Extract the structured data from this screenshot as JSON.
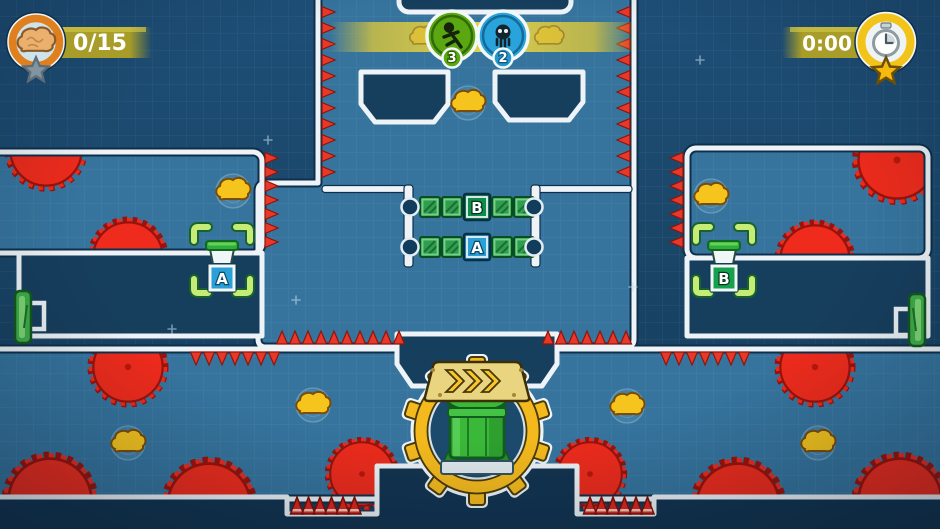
{
  "app": {
    "name": "co-op puzzle platformer level",
    "view": "level-playfield"
  },
  "hud": {
    "brains_counter": {
      "value": "0/15",
      "icon": "brain-icon",
      "medal_icon": "star-icon"
    },
    "timer": {
      "value": "0:00",
      "icon": "stopwatch-icon",
      "medal_icon": "star-icon"
    },
    "spawn_counters": [
      {
        "icon": "runner-icon",
        "color": "#5aa712",
        "count": "3"
      },
      {
        "icon": "skull-icon",
        "color": "#28a3dc",
        "count": "2"
      }
    ]
  },
  "labels": {
    "a": "A",
    "b": "B"
  },
  "level": {
    "bridges": [
      {
        "label": "B",
        "label_color": "#0e8c4a",
        "row": "top"
      },
      {
        "label": "A",
        "label_color": "#2b9fd8",
        "row": "bottom"
      }
    ],
    "targets": [
      {
        "label": "A",
        "side": "left",
        "sign_color": "#2b9fd8"
      },
      {
        "label": "B",
        "side": "right",
        "sign_color": "#16a14d"
      }
    ],
    "entities": {
      "brain_pickups": 7,
      "saw_blades": 12,
      "exit_doors": 2,
      "crate_bridges": 2,
      "spawner_pipes": 1,
      "goal_brackets": 2,
      "spike_pits": 2
    },
    "saws": [
      {
        "x": 46,
        "y": 150,
        "r": 37,
        "clip": "room-left"
      },
      {
        "x": 128,
        "y": 257,
        "r": 36,
        "clip": "room-left"
      },
      {
        "x": 897,
        "y": 160,
        "r": 40,
        "clip": "room-right"
      },
      {
        "x": 815,
        "y": 260,
        "r": 36,
        "clip": "room-right"
      },
      {
        "x": 50,
        "y": 500,
        "r": 43,
        "clip": "band"
      },
      {
        "x": 209,
        "y": 505,
        "r": 43,
        "clip": "band"
      },
      {
        "x": 128,
        "y": 367,
        "r": 36,
        "clip": "band"
      },
      {
        "x": 815,
        "y": 367,
        "r": 36,
        "clip": "band"
      },
      {
        "x": 362,
        "y": 474,
        "r": 33,
        "clip": "band"
      },
      {
        "x": 590,
        "y": 474,
        "r": 33,
        "clip": "band"
      },
      {
        "x": 738,
        "y": 505,
        "r": 43,
        "clip": "band"
      },
      {
        "x": 900,
        "y": 500,
        "r": 43,
        "clip": "band"
      }
    ],
    "brains": [
      {
        "x": 468,
        "y": 103
      },
      {
        "x": 233,
        "y": 191
      },
      {
        "x": 711,
        "y": 196
      },
      {
        "x": 128,
        "y": 443
      },
      {
        "x": 313,
        "y": 405
      },
      {
        "x": 627,
        "y": 406
      },
      {
        "x": 818,
        "y": 443
      }
    ],
    "spike_rows": [
      {
        "x": 322,
        "y": 12,
        "count": 11,
        "gap": 16,
        "dir": "right"
      },
      {
        "x": 630,
        "y": 12,
        "count": 11,
        "gap": 16,
        "dir": "left"
      },
      {
        "x": 265,
        "y": 158,
        "count": 7,
        "gap": 14,
        "dir": "right"
      },
      {
        "x": 683,
        "y": 158,
        "count": 7,
        "gap": 14,
        "dir": "left"
      },
      {
        "x": 282,
        "y": 344,
        "count": 10,
        "gap": 13,
        "dir": "up"
      },
      {
        "x": 548,
        "y": 344,
        "count": 7,
        "gap": 13,
        "dir": "up"
      },
      {
        "x": 196,
        "y": 352,
        "count": 7,
        "gap": 13,
        "dir": "down"
      },
      {
        "x": 666,
        "y": 352,
        "count": 7,
        "gap": 13,
        "dir": "down"
      }
    ],
    "cones": [
      {
        "x": 297,
        "y": 514,
        "count": 6,
        "gap": 11.5
      },
      {
        "x": 590,
        "y": 514,
        "count": 6,
        "gap": 11.5
      }
    ],
    "sparkles": [
      {
        "x": 296,
        "y": 300
      },
      {
        "x": 633,
        "y": 287
      },
      {
        "x": 268,
        "y": 140
      },
      {
        "x": 172,
        "y": 329
      },
      {
        "x": 700,
        "y": 60
      }
    ]
  },
  "palette": {
    "void_blue": "#1a4668",
    "play_blue": "#36749e",
    "wall_white": "#edf3f6",
    "saw_red": "#ee2b1c",
    "spike_red": "#e0251b",
    "gear_yellow": "#f4b91d",
    "crate_green": "#2f9e4e",
    "door_green": "#3fae49",
    "hud_olive": "#a89d28",
    "brain_yellow": "#f5c41d",
    "badge_green": "#5aa712",
    "badge_blue": "#28a3dc"
  }
}
